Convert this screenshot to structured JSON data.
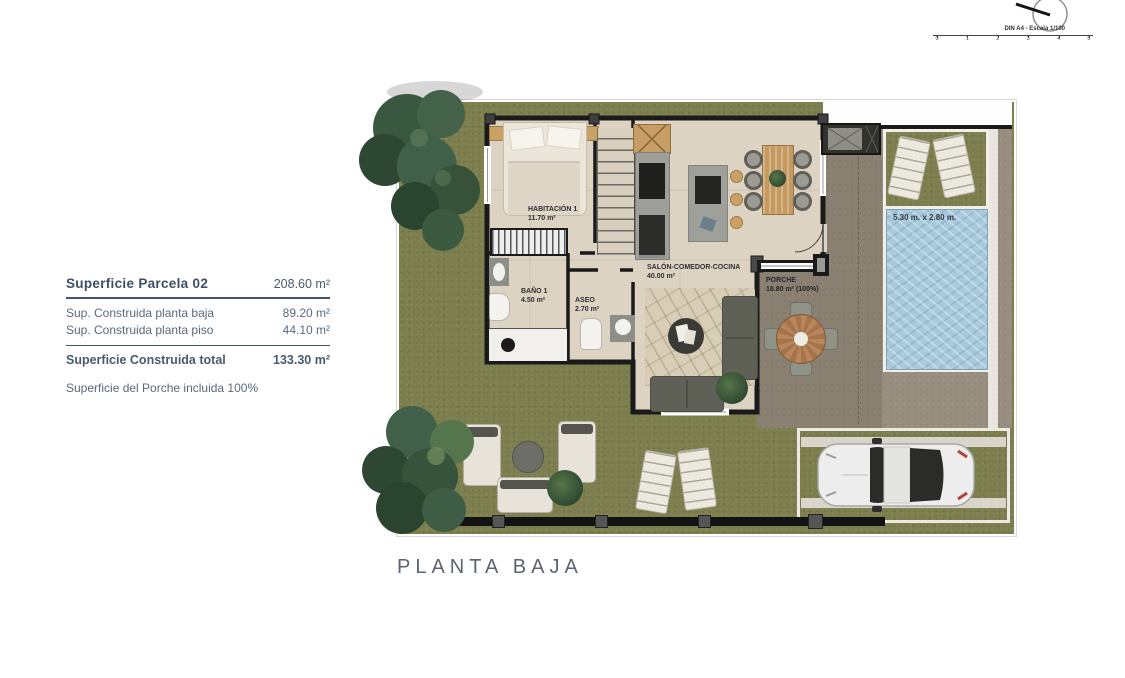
{
  "title": "PLANTA BAJA",
  "scale_bar": {
    "label": "DIN A4 - Escala 1/100",
    "ticks": [
      "0",
      "1",
      "2",
      "3",
      "4",
      "5"
    ]
  },
  "legend": {
    "title": "Superficie Parcela 02",
    "title_value": "208.60 m²",
    "rows": [
      {
        "label": "Sup. Construida planta baja",
        "value": "89.20 m²"
      },
      {
        "label": "Sup. Construida planta piso",
        "value": "44.10 m²"
      }
    ],
    "total": {
      "label": "Superficie Construida total",
      "value": "133.30 m²"
    },
    "note": "Superficie del Porche incluida 100%"
  },
  "plan": {
    "rooms": {
      "habitacion1": {
        "name": "HABITACIÓN 1",
        "area": "11.70 m²"
      },
      "bano1": {
        "name": "BAÑO 1",
        "area": "4.50 m²"
      },
      "aseo": {
        "name": "ASEO",
        "area": "2.70 m²"
      },
      "salon": {
        "name": "SALÓN-COMEDOR-COCINA",
        "area": "40.00 m²"
      },
      "porche": {
        "name": "PORCHE",
        "area": "18.80 m² (100%)"
      }
    },
    "pool": {
      "dimensions": "5.30 m. x 2.80 m."
    }
  },
  "colors": {
    "grass": "#7c7e4e",
    "floor": "#ddd3c2",
    "deck": "#998f80",
    "porch": "#8b8173",
    "pool_water": "#a9cadd",
    "wall": "#1a1a1a",
    "legend_text": "#44546a"
  }
}
